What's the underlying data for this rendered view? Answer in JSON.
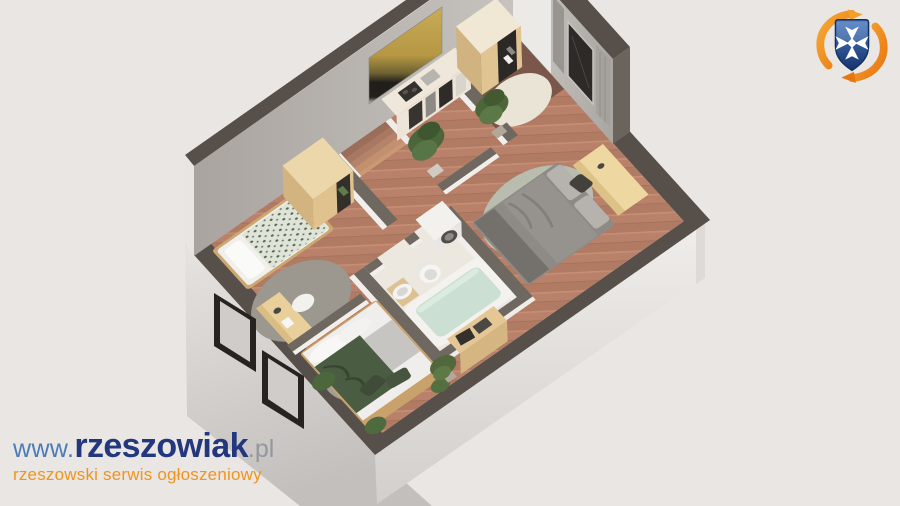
{
  "meta": {
    "description": "3D isometric cutaway floor plan render of a one-bedroom attic apartment",
    "canvas": {
      "width": 900,
      "height": 506
    }
  },
  "branding": {
    "watermark": {
      "prefix": "www.",
      "name": "rzeszowiak",
      "suffix": ".pl",
      "tagline": "rzeszowski serwis ogłoszeniowy",
      "colors": {
        "prefix": "#4b7cb6",
        "name": "#22377e",
        "suffix": "#94979e",
        "tagline": "#f0941c"
      }
    },
    "crest": {
      "label": "rzeszowiak-crest",
      "shield": "#2e5fae",
      "shield_dark": "#16336c",
      "cross": "#ffffff",
      "swoosh": "#ef8d15",
      "swoosh_light": "#f7a937"
    }
  },
  "scene": {
    "background": "#e9e6e3",
    "palette": {
      "wall_cap": "#57504a",
      "wall_cap_inner": "#6f6861",
      "wall_inner_face": "#b3aeaa",
      "wall_outer_face": "#d9d6d3",
      "floor_wood": "#b9816a",
      "floor_hall": "#7b564a",
      "floor_bath": "#ece7df",
      "rug_gray": "#9c978f",
      "rug_sage": "#b9bdb0",
      "rug_cream": "#e9e4d5",
      "wood_furniture": "#e0c28e",
      "bed_white": "#f1efec",
      "bed_gray": "#8e8b87",
      "blanket_green": "#4a5c42",
      "blanket_speckled": "#dfe4d8",
      "plant_green": "#4c663a",
      "bath_water": "#cbdfd2",
      "window_frame": "#262321",
      "painting_gold": "#c3a24d"
    },
    "rooms": [
      {
        "name": "entry-hall",
        "furniture": [
          "open-closet",
          "round-rug",
          "potted-plant"
        ]
      },
      {
        "name": "living-bedroom",
        "furniture": [
          "double-bed-gray",
          "round-rug",
          "desk",
          "curtains",
          "window",
          "potted-plant"
        ]
      },
      {
        "name": "kitchen-corridor",
        "furniture": [
          "kitchen-counter",
          "staircase",
          "wall-painting"
        ]
      },
      {
        "name": "bathroom",
        "furniture": [
          "bathtub",
          "washing-machine",
          "toilet",
          "sink"
        ]
      },
      {
        "name": "small-bedroom",
        "furniture": [
          "single-bed",
          "wardrobe",
          "desk",
          "round-rug",
          "skylight-window"
        ]
      },
      {
        "name": "master-bedroom",
        "furniture": [
          "double-bed-green",
          "round-rug",
          "clothes-shelf",
          "plants",
          "skylight-window"
        ]
      }
    ]
  }
}
